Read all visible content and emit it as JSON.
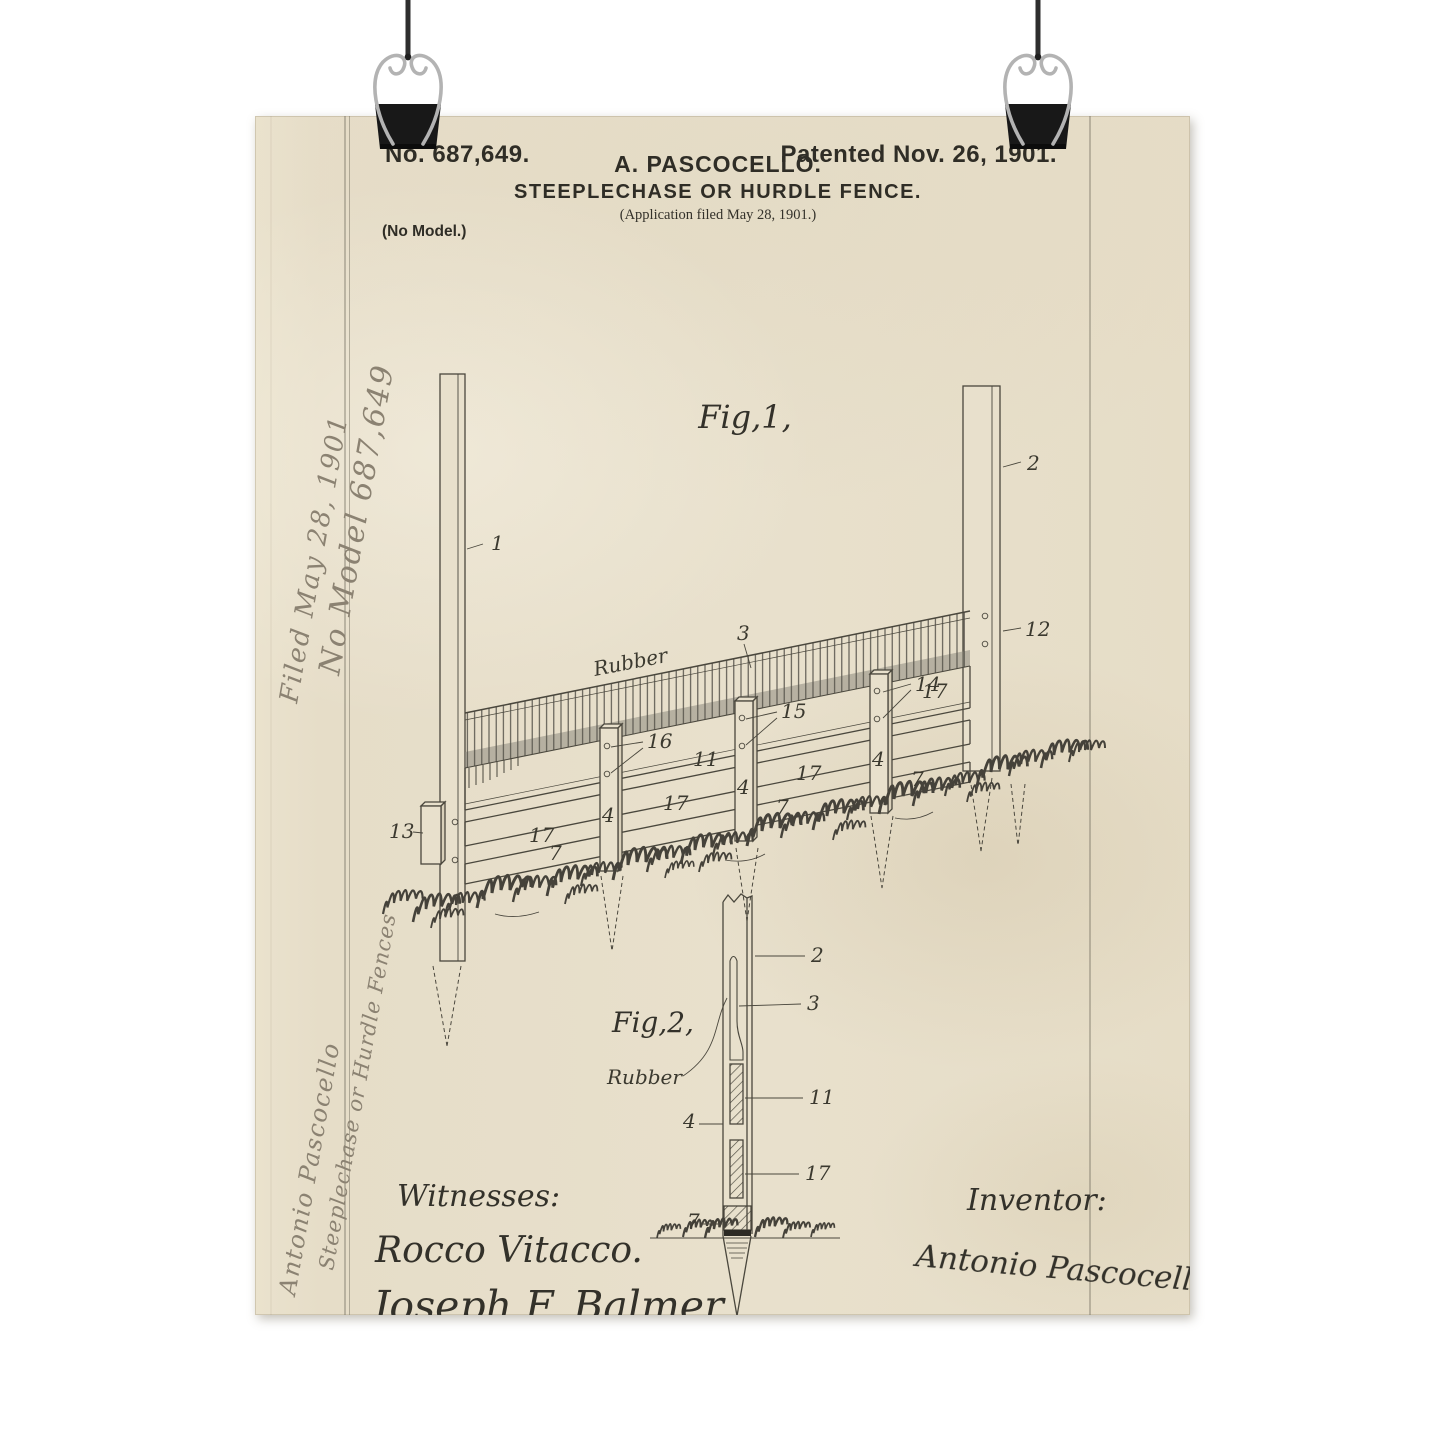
{
  "scene": {
    "background_color": "#ffffff"
  },
  "paper": {
    "header": {
      "patent_number": "No. 687,649.",
      "patented": "Patented Nov. 26, 1901.",
      "inventor_name": "A. PASCOCELLO.",
      "title": "STEEPLECHASE OR HURDLE FENCE.",
      "application_line": "(Application filed May 28, 1901.)",
      "no_model": "(No Model.)"
    },
    "margin_notes": {
      "filed": "Filed May 28, 1901",
      "no_model_number": "No Model 687,649",
      "inventor": "Antonio Pascocello",
      "title": "Steeplechase or Hurdle Fences"
    },
    "fig1": {
      "caption": "Fig,1,",
      "rubber": "Rubber",
      "labels": {
        "left_post": "1",
        "right_post": "2",
        "rubber_fringe": "3",
        "upright": "4",
        "bottom_rail": "7",
        "middle_rail": "11",
        "post_holes": "12",
        "slide_block": "13",
        "upright3_holes": "14",
        "upright2_holes": "15",
        "upright1_holes": "16",
        "panel_rail": "17"
      }
    },
    "fig2": {
      "caption": "Fig,2,",
      "rubber": "Rubber",
      "labels": {
        "post": "2",
        "rubber_strip": "3",
        "upright": "4",
        "ground_block": "7",
        "upper_block": "11",
        "lower_block": "17"
      }
    },
    "signatures": {
      "witnesses_label": "Witnesses:",
      "witness_1": "Rocco Vitacco.",
      "witness_2": "Joseph F. Balmer",
      "inventor_label": "Inventor:",
      "inventor_signature": "Antonio Pascocello,"
    },
    "colors": {
      "paper": "#e7dfca",
      "printed_ink": "#2f2d26",
      "drawing_ink": "#4a473d",
      "pencil": "#8b8272",
      "clip_body": "#181818",
      "clip_wire": "#b3b3b3"
    }
  }
}
